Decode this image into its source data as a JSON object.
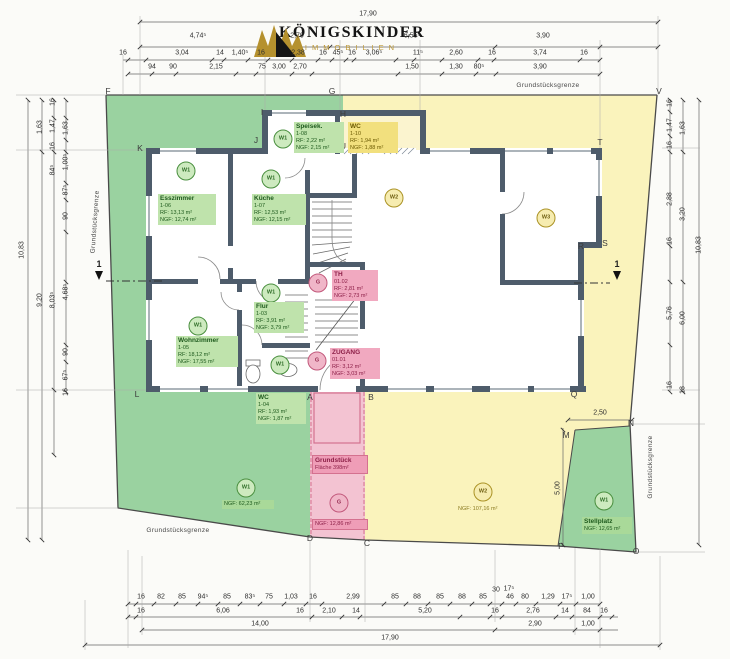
{
  "logo": {
    "title": "KÖNIGSKINDER",
    "subtitle": "IMMOBILIEN"
  },
  "colors": {
    "site_green": "#9ad2a0",
    "site_yellow": "#faf3bc",
    "site_pink": "#f3c3d2",
    "wall": "#4e5c6b",
    "marker_green": "#4a8f3f",
    "marker_yellow": "#ab9326",
    "marker_pink": "#c2597c"
  },
  "boundary_labels": [
    {
      "t": "Grundstücksgrenze",
      "x": 548,
      "y": 86,
      "rot": 0
    },
    {
      "t": "Grundstücksgrenze",
      "x": 96,
      "y": 222,
      "rot": -86
    },
    {
      "t": "Grundstücksgrenze",
      "x": 651,
      "y": 467,
      "rot": -90
    },
    {
      "t": "Grundstücksgrenze",
      "x": 178,
      "y": 531,
      "rot": 0
    }
  ],
  "section": {
    "label": "1"
  },
  "section_markers": [
    {
      "x": 99,
      "y": 264
    },
    {
      "x": 617,
      "y": 264
    }
  ],
  "letters": [
    {
      "t": "F",
      "x": 108,
      "y": 91
    },
    {
      "t": "G",
      "x": 332,
      "y": 91
    },
    {
      "t": "V",
      "x": 659,
      "y": 91
    },
    {
      "t": "K",
      "x": 140,
      "y": 148
    },
    {
      "t": "I",
      "x": 262,
      "y": 112
    },
    {
      "t": "J",
      "x": 256,
      "y": 140
    },
    {
      "t": "H",
      "x": 343,
      "y": 114
    },
    {
      "t": "U",
      "x": 343,
      "y": 146
    },
    {
      "t": "T",
      "x": 600,
      "y": 142
    },
    {
      "t": "S",
      "x": 605,
      "y": 243
    },
    {
      "t": "R",
      "x": 581,
      "y": 246
    },
    {
      "t": "Q",
      "x": 574,
      "y": 394
    },
    {
      "t": "L",
      "x": 137,
      "y": 394
    },
    {
      "t": "A",
      "x": 310,
      "y": 397
    },
    {
      "t": "B",
      "x": 371,
      "y": 397
    },
    {
      "t": "M",
      "x": 566,
      "y": 435
    },
    {
      "t": "N",
      "x": 631,
      "y": 423
    },
    {
      "t": "D",
      "x": 310,
      "y": 538
    },
    {
      "t": "C",
      "x": 367,
      "y": 543
    },
    {
      "t": "P",
      "x": 561,
      "y": 546
    },
    {
      "t": "O",
      "x": 636,
      "y": 551
    }
  ],
  "dims": {
    "top": [
      {
        "t": "17,90",
        "x": 368,
        "y": 14
      },
      {
        "t": "4,74⁵",
        "x": 198,
        "y": 36
      },
      {
        "t": "2,70",
        "x": 297,
        "y": 36
      },
      {
        "t": "6,55⁵",
        "x": 412,
        "y": 36
      },
      {
        "t": "3,90",
        "x": 543,
        "y": 36
      },
      {
        "t": "16",
        "x": 123,
        "y": 53
      },
      {
        "t": "3,04",
        "x": 182,
        "y": 53
      },
      {
        "t": "14",
        "x": 220,
        "y": 53
      },
      {
        "t": "1,40⁵",
        "x": 240,
        "y": 53
      },
      {
        "t": "16",
        "x": 261,
        "y": 53
      },
      {
        "t": "2,38",
        "x": 298,
        "y": 53
      },
      {
        "t": "16",
        "x": 323,
        "y": 53
      },
      {
        "t": "45⁵",
        "x": 338,
        "y": 53
      },
      {
        "t": "16",
        "x": 352,
        "y": 53
      },
      {
        "t": "3,06⁵",
        "x": 374,
        "y": 53
      },
      {
        "t": "11⁵",
        "x": 418,
        "y": 53
      },
      {
        "t": "2,60",
        "x": 456,
        "y": 53
      },
      {
        "t": "16",
        "x": 492,
        "y": 53
      },
      {
        "t": "3,74",
        "x": 540,
        "y": 53
      },
      {
        "t": "16",
        "x": 584,
        "y": 53
      },
      {
        "t": "94",
        "x": 152,
        "y": 67
      },
      {
        "t": "90",
        "x": 173,
        "y": 67
      },
      {
        "t": "2,15",
        "x": 216,
        "y": 67
      },
      {
        "t": "75",
        "x": 262,
        "y": 67
      },
      {
        "t": "3,00",
        "x": 279,
        "y": 67
      },
      {
        "t": "2,70",
        "x": 300,
        "y": 67
      },
      {
        "t": "1,50",
        "x": 412,
        "y": 67
      },
      {
        "t": "1,30",
        "x": 456,
        "y": 67
      },
      {
        "t": "80⁵",
        "x": 479,
        "y": 67
      },
      {
        "t": "3,90",
        "x": 540,
        "y": 67
      }
    ],
    "bottom": [
      {
        "t": "16",
        "x": 141,
        "y": 597
      },
      {
        "t": "82",
        "x": 161,
        "y": 597
      },
      {
        "t": "85",
        "x": 182,
        "y": 597
      },
      {
        "t": "94⁵",
        "x": 203,
        "y": 597
      },
      {
        "t": "85",
        "x": 227,
        "y": 597
      },
      {
        "t": "83⁵",
        "x": 250,
        "y": 597
      },
      {
        "t": "75",
        "x": 269,
        "y": 597
      },
      {
        "t": "1,03",
        "x": 291,
        "y": 597
      },
      {
        "t": "16",
        "x": 313,
        "y": 597
      },
      {
        "t": "2,99",
        "x": 353,
        "y": 597
      },
      {
        "t": "85",
        "x": 395,
        "y": 597
      },
      {
        "t": "88",
        "x": 417,
        "y": 597
      },
      {
        "t": "85",
        "x": 440,
        "y": 597
      },
      {
        "t": "88",
        "x": 462,
        "y": 597
      },
      {
        "t": "85",
        "x": 483,
        "y": 597
      },
      {
        "t": "30",
        "x": 496,
        "y": 590
      },
      {
        "t": "17⁵",
        "x": 509,
        "y": 589
      },
      {
        "t": "46",
        "x": 510,
        "y": 597
      },
      {
        "t": "80",
        "x": 525,
        "y": 597
      },
      {
        "t": "1,29",
        "x": 548,
        "y": 597
      },
      {
        "t": "17⁵",
        "x": 567,
        "y": 597
      },
      {
        "t": "1,00",
        "x": 588,
        "y": 597
      },
      {
        "t": "16",
        "x": 141,
        "y": 611
      },
      {
        "t": "6,06",
        "x": 223,
        "y": 611
      },
      {
        "t": "16",
        "x": 300,
        "y": 611
      },
      {
        "t": "2,10",
        "x": 329,
        "y": 611
      },
      {
        "t": "14",
        "x": 356,
        "y": 611
      },
      {
        "t": "5,20",
        "x": 425,
        "y": 611
      },
      {
        "t": "16",
        "x": 495,
        "y": 611
      },
      {
        "t": "2,76",
        "x": 533,
        "y": 611
      },
      {
        "t": "14",
        "x": 565,
        "y": 611
      },
      {
        "t": "84",
        "x": 587,
        "y": 611
      },
      {
        "t": "16",
        "x": 604,
        "y": 611
      },
      {
        "t": "14,00",
        "x": 260,
        "y": 624
      },
      {
        "t": "2,90",
        "x": 535,
        "y": 624
      },
      {
        "t": "1,00",
        "x": 588,
        "y": 624
      },
      {
        "t": "17,90",
        "x": 390,
        "y": 638
      }
    ],
    "left": [
      {
        "t": "10,83",
        "x": 22,
        "y": 250
      },
      {
        "t": "1,63",
        "x": 40,
        "y": 127
      },
      {
        "t": "9,20",
        "x": 40,
        "y": 300
      },
      {
        "t": "16",
        "x": 53,
        "y": 102
      },
      {
        "t": "1,47",
        "x": 53,
        "y": 126
      },
      {
        "t": "16",
        "x": 53,
        "y": 146
      },
      {
        "t": "84⁵",
        "x": 53,
        "y": 170
      },
      {
        "t": "8,03⁵",
        "x": 53,
        "y": 300
      },
      {
        "t": "1,63",
        "x": 66,
        "y": 128
      },
      {
        "t": "1,00⁵",
        "x": 66,
        "y": 162
      },
      {
        "t": "87⁵",
        "x": 66,
        "y": 190
      },
      {
        "t": "90",
        "x": 66,
        "y": 216
      },
      {
        "t": "4,68⁵",
        "x": 66,
        "y": 292
      },
      {
        "t": "90",
        "x": 66,
        "y": 352
      },
      {
        "t": "67⁵",
        "x": 66,
        "y": 375
      },
      {
        "t": "16",
        "x": 66,
        "y": 392
      }
    ],
    "right": [
      {
        "t": "16",
        "x": 670,
        "y": 103
      },
      {
        "t": "1,47",
        "x": 670,
        "y": 125
      },
      {
        "t": "16",
        "x": 670,
        "y": 145
      },
      {
        "t": "2,88",
        "x": 670,
        "y": 199
      },
      {
        "t": "16",
        "x": 670,
        "y": 241
      },
      {
        "t": "5,76",
        "x": 670,
        "y": 313
      },
      {
        "t": "16",
        "x": 670,
        "y": 385
      },
      {
        "t": "1,63",
        "x": 683,
        "y": 128
      },
      {
        "t": "3,20",
        "x": 683,
        "y": 214
      },
      {
        "t": "6,00",
        "x": 683,
        "y": 318
      },
      {
        "t": "18",
        "x": 683,
        "y": 390
      },
      {
        "t": "10,83",
        "x": 699,
        "y": 245
      }
    ],
    "mid": [
      {
        "t": "2,50",
        "x": 600,
        "y": 413,
        "rot": 0
      },
      {
        "t": "5,00",
        "x": 558,
        "y": 488,
        "rot": -90
      }
    ]
  },
  "boxes": [
    {
      "x": 158,
      "y": 194,
      "w": 54,
      "theme": "green",
      "title": "Esszimmer",
      "lines": [
        "1-06",
        "RF:   13,13 m²",
        "NGF: 12,74 m²"
      ]
    },
    {
      "x": 294,
      "y": 122,
      "w": 46,
      "theme": "green",
      "title": "Speisek.",
      "lines": [
        "1-08",
        "RF:   2,22 m²",
        "NGF: 2,15 m²"
      ]
    },
    {
      "x": 252,
      "y": 194,
      "w": 50,
      "theme": "green",
      "title": "Küche",
      "lines": [
        "1-07",
        "RF:   12,53 m²",
        "NGF: 12,15 m²"
      ]
    },
    {
      "x": 348,
      "y": 122,
      "w": 46,
      "theme": "yellow",
      "title": "WC",
      "lines": [
        "1-10",
        "RF:   1,94 m²",
        "NGF: 1,88 m²"
      ]
    },
    {
      "x": 332,
      "y": 270,
      "w": 42,
      "theme": "pink",
      "title": "TH",
      "lines": [
        "01.02",
        "RF:   2,81 m²",
        "NGF: 2,73 m²"
      ]
    },
    {
      "x": 254,
      "y": 302,
      "w": 46,
      "theme": "green",
      "title": "Flur",
      "lines": [
        "1-03",
        "RF:   3,91 m²",
        "NGF: 3,79 m²"
      ]
    },
    {
      "x": 176,
      "y": 336,
      "w": 58,
      "theme": "green",
      "title": "Wohnzimmer",
      "lines": [
        "1-05",
        "RF:   18,12 m²",
        "NGF: 17,55 m²"
      ]
    },
    {
      "x": 256,
      "y": 393,
      "w": 46,
      "theme": "green",
      "title": "WC",
      "lines": [
        "1-04",
        "RF:   1,93 m²",
        "NGF: 1,87 m²"
      ]
    },
    {
      "x": 330,
      "y": 348,
      "w": 46,
      "theme": "pink",
      "title": "ZUGANG",
      "lines": [
        "01.01",
        "RF:   3,12 m²",
        "NGF: 3,03 m²"
      ]
    },
    {
      "x": 312,
      "y": 455,
      "w": 50,
      "theme": "pinkstrong",
      "title": "Grundstück",
      "lines": [
        "Fläche 398m²"
      ]
    },
    {
      "x": 312,
      "y": 519,
      "w": 50,
      "theme": "pinkstrong",
      "lines": [
        "NGF: 12,86 m²"
      ]
    },
    {
      "x": 222,
      "y": 500,
      "w": 48,
      "theme": "greenstrip",
      "lines": [
        "NGF: 62,23 m²"
      ]
    },
    {
      "x": 456,
      "y": 505,
      "w": 54,
      "theme": "plain-yellow",
      "lines": [
        "NGF: 107,16 m²"
      ]
    },
    {
      "x": 582,
      "y": 517,
      "w": 46,
      "theme": "greenstrip",
      "title": "Stellplatz",
      "lines": [
        "NGF: 12,65 m²"
      ]
    }
  ],
  "circles": [
    {
      "t": "W1",
      "x": 186,
      "y": 171,
      "k": "cw1"
    },
    {
      "t": "W1",
      "x": 283,
      "y": 139,
      "k": "cw1"
    },
    {
      "t": "W1",
      "x": 271,
      "y": 179,
      "k": "cw1"
    },
    {
      "t": "W2",
      "x": 394,
      "y": 198,
      "k": "cw2"
    },
    {
      "t": "W3",
      "x": 546,
      "y": 218,
      "k": "cw2"
    },
    {
      "t": "G",
      "x": 318,
      "y": 283,
      "k": "cg"
    },
    {
      "t": "W1",
      "x": 271,
      "y": 293,
      "k": "cw1"
    },
    {
      "t": "W1",
      "x": 198,
      "y": 326,
      "k": "cw1"
    },
    {
      "t": "W1",
      "x": 280,
      "y": 365,
      "k": "cw1"
    },
    {
      "t": "G",
      "x": 317,
      "y": 361,
      "k": "cg"
    },
    {
      "t": "G",
      "x": 339,
      "y": 503,
      "k": "cg"
    },
    {
      "t": "W1",
      "x": 246,
      "y": 488,
      "k": "cw1"
    },
    {
      "t": "W2",
      "x": 483,
      "y": 492,
      "k": "cw2"
    },
    {
      "t": "W1",
      "x": 604,
      "y": 501,
      "k": "cw1"
    }
  ]
}
